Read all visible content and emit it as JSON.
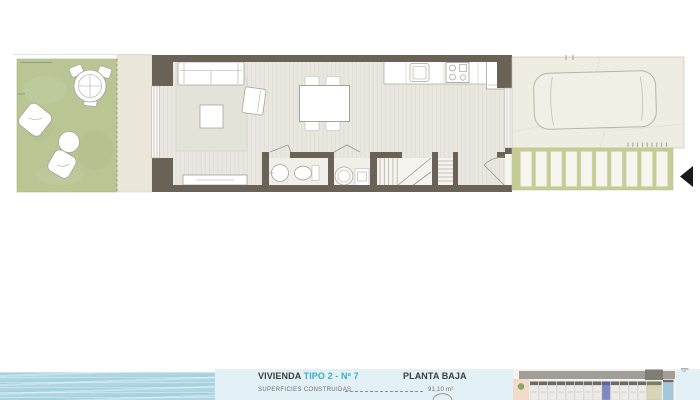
{
  "title_block": {
    "unit_label": "VIVIENDA",
    "unit_type": "TIPO 2 - Nº 7",
    "floor_label": "PLANTA BAJA",
    "surfaces_label": "SUPERFICIES CONSTRUIDAS",
    "surfaces_value": "91,10 m²"
  },
  "colors": {
    "wall": "#6b6257",
    "floor-a": "#e9e7e0",
    "floor-b": "#e0ddd5",
    "garden": "#b9c694",
    "porch": "#eae6d9",
    "parking": "#efece2",
    "drive": "#c5cd95",
    "paver": "#f7f5ee",
    "accent": "#35b0c8",
    "water": "#aed6e4",
    "panel": "#e3f1f6",
    "road": "#a19d97",
    "road-dark": "#807c76",
    "unit-roof": "#6f6a63",
    "unit-body": "#edebe7",
    "unit-highlight": "#8088c1",
    "pool": "#a3c8da",
    "peach": "#f2dbc8",
    "text-dark": "#3c3c3c",
    "text-gray": "#6e6e6e",
    "arrow-black": "#191919"
  }
}
